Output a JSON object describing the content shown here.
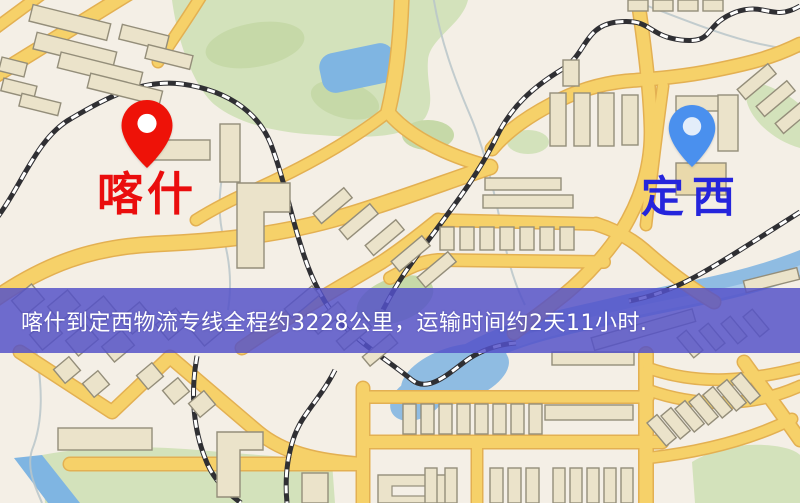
{
  "banner": {
    "text": "喀什到定西物流专线全程约3228公里，运输时间约2天11小时."
  },
  "markers": {
    "origin": {
      "label": "喀什",
      "pin_color": "#ee1208",
      "hole_color": "#ffffff",
      "label_color": "#ea0d0d",
      "x": 147,
      "y": 168
    },
    "destination": {
      "label": "定西",
      "pin_color": "#4a90ee",
      "hole_color": "#e3edfa",
      "label_color": "#2525dc",
      "x": 692,
      "y": 167
    }
  },
  "icons": {
    "origin_pin": "red-location-pin-icon",
    "destination_pin": "blue-location-pin-icon"
  },
  "theme": {
    "map-bg": "#f4efe6",
    "road-fill": "#f6d169",
    "road-casing": "#e3b052",
    "building-fill": "#ebe3ca",
    "building-tan": "#e9d9ab",
    "building-stroke": "#948e7a",
    "park": "#d3e2bb",
    "park-dark": "#c6d9a8",
    "water": "#7fb5e2",
    "river": "#8fbce2",
    "stream": "#b9c5c9",
    "rail-dark": "#2f2f33",
    "rail-light": "#ffffff",
    "banner-bg": "rgba(83,81,200,0.84)",
    "banner-text": "#ffffff"
  }
}
